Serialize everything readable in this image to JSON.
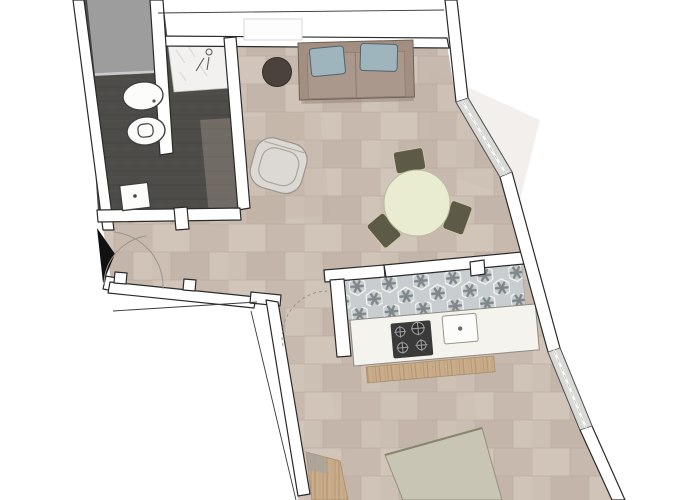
{
  "floorplan": {
    "rooms": [
      "bathroom",
      "entry",
      "living-room",
      "kitchen",
      "bedroom"
    ],
    "furniture": [
      "sofa",
      "pouf",
      "armchair",
      "dining-table",
      "dining-chair",
      "bed",
      "kitchen-counter",
      "cooktop",
      "kitchen-sink",
      "wood-shelf",
      "wood-slats",
      "toilet",
      "bidet",
      "washbasin",
      "shower"
    ],
    "colors": {
      "wall_fill": "#ffffff",
      "wall_outline": "#2a2a2a",
      "floor_base": "#cdc0b6",
      "floor_seam": "#b7a99d",
      "bath_tile": "#4e4c49",
      "gray_area": "#9d9d9d",
      "marble": "#f2f1ef",
      "kitchen_tile": "#c8cdd0",
      "kitchen_star": "#80878b",
      "counter": "#f5f3ee",
      "cooktop": "#3a3a3a",
      "fixture_white": "#fcfcfb",
      "window": "#d9d9d6",
      "sofa": "#a28f81",
      "sofa_seat": "#ab988c",
      "pillow": "#9fb5be",
      "pouf": "#4b423b",
      "armchair": "#dcd9d4",
      "table": "#eaecd1",
      "chair": "#5d5a48",
      "bed": "#c9c5b4",
      "wood": "#c9ad8b",
      "door": "#111111",
      "swing_arc": "#9b948c"
    }
  }
}
